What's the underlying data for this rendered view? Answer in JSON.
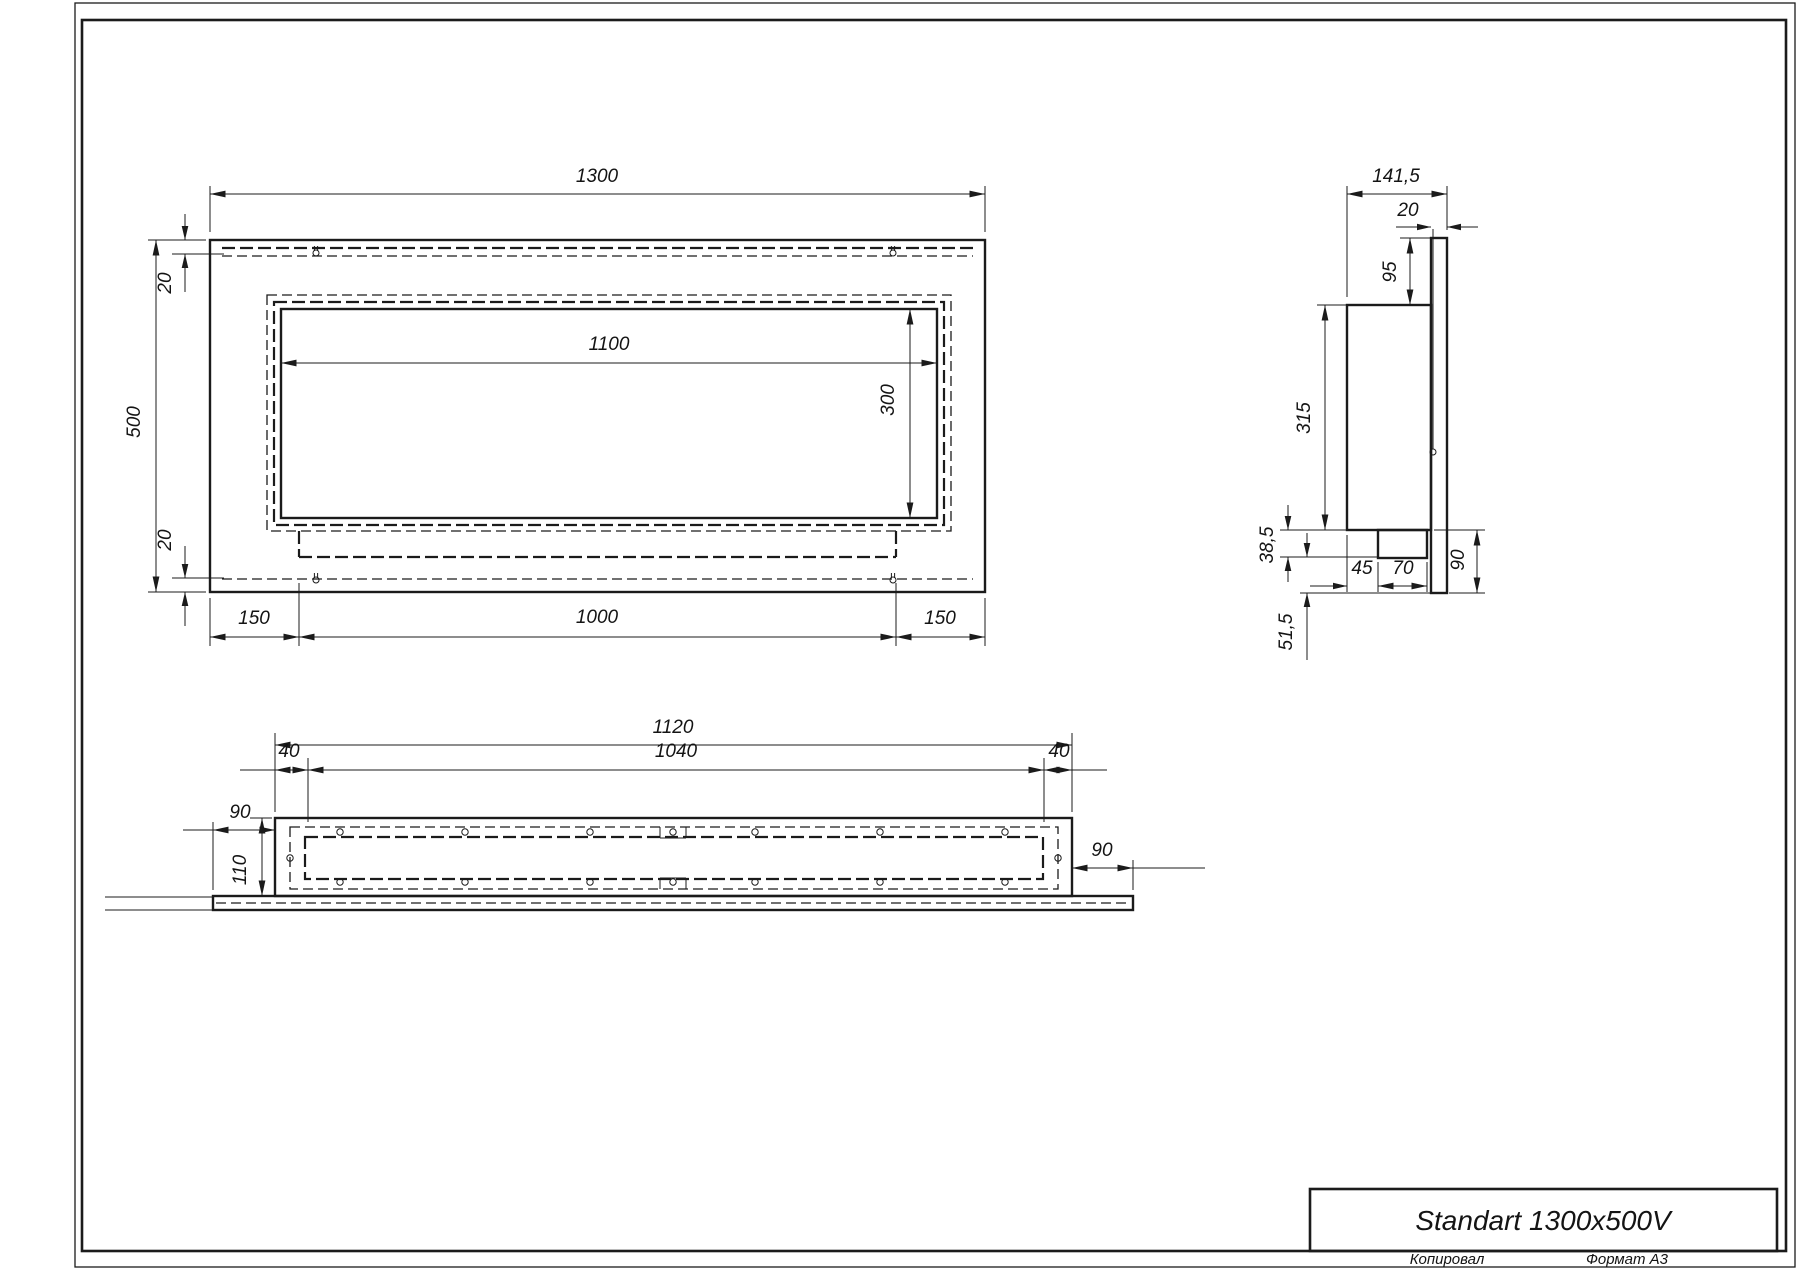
{
  "drawing": {
    "ink_color": "#1b1b1b",
    "paper_color": "#ffffff"
  },
  "front_view": {
    "width_total": "1300",
    "height_total": "500",
    "inset_top": "20",
    "inset_bottom": "20",
    "opening_width": "1100",
    "opening_height": "300",
    "bottom_left": "150",
    "bottom_center": "1000",
    "bottom_right": "150"
  },
  "side_view": {
    "depth_total": "141,5",
    "flange_thickness": "20",
    "top_to_body": "95",
    "body_height": "315",
    "tray_height": "38,5",
    "tray_offset": "45",
    "tray_width": "70",
    "flange_bottom_extension": "90",
    "bottom_clearance": "51,5"
  },
  "bottom_view": {
    "body_width": "1120",
    "opening_width": "1040",
    "margin_left": "40",
    "margin_right": "40",
    "flange_overhang_left": "90",
    "flange_overhang_right": "90",
    "depth": "110"
  },
  "title_block": {
    "product_name": "Standart 1300x500V",
    "copied_by_label": "Копировал",
    "format_label": "Формат А3"
  }
}
